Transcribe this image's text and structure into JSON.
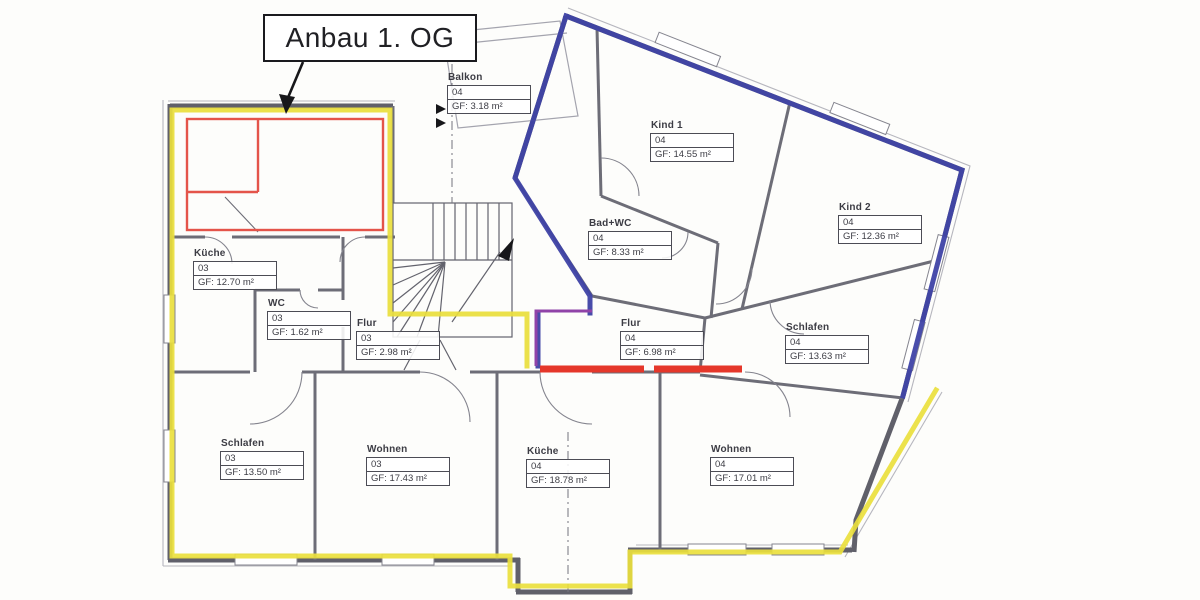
{
  "title": {
    "label": "Anbau 1. OG"
  },
  "colors": {
    "unit03_highlight_yellow": "#eadf3d",
    "unit04_highlight_blue": "#3f43a6",
    "anbau_new_wall_red": "#e4544a",
    "marking_red": "#e5372a",
    "marking_purple": "#9043a8",
    "wall_gray": "#60606a"
  },
  "rooms": [
    {
      "name": "Balkon",
      "unit": "04",
      "area": "GF: 3.18 m²"
    },
    {
      "name": "Kind 1",
      "unit": "04",
      "area": "GF: 14.55 m²"
    },
    {
      "name": "Kind 2",
      "unit": "04",
      "area": "GF: 12.36 m²"
    },
    {
      "name": "Bad+WC",
      "unit": "04",
      "area": "GF: 8.33 m²"
    },
    {
      "name": "Küche",
      "unit": "03",
      "area": "GF: 12.70 m²"
    },
    {
      "name": "WC",
      "unit": "03",
      "area": "GF: 1.62 m²"
    },
    {
      "name": "Flur",
      "unit": "03",
      "area": "GF: 2.98 m²"
    },
    {
      "name": "Flur",
      "unit": "04",
      "area": "GF: 6.98 m²"
    },
    {
      "name": "Schlafen",
      "unit": "04",
      "area": "GF: 13.63 m²"
    },
    {
      "name": "Schlafen",
      "unit": "03",
      "area": "GF: 13.50 m²"
    },
    {
      "name": "Wohnen",
      "unit": "03",
      "area": "GF: 17.43 m²"
    },
    {
      "name": "Küche",
      "unit": "04",
      "area": "GF: 18.78 m²"
    },
    {
      "name": "Wohnen",
      "unit": "04",
      "area": "GF: 17.01 m²"
    }
  ]
}
